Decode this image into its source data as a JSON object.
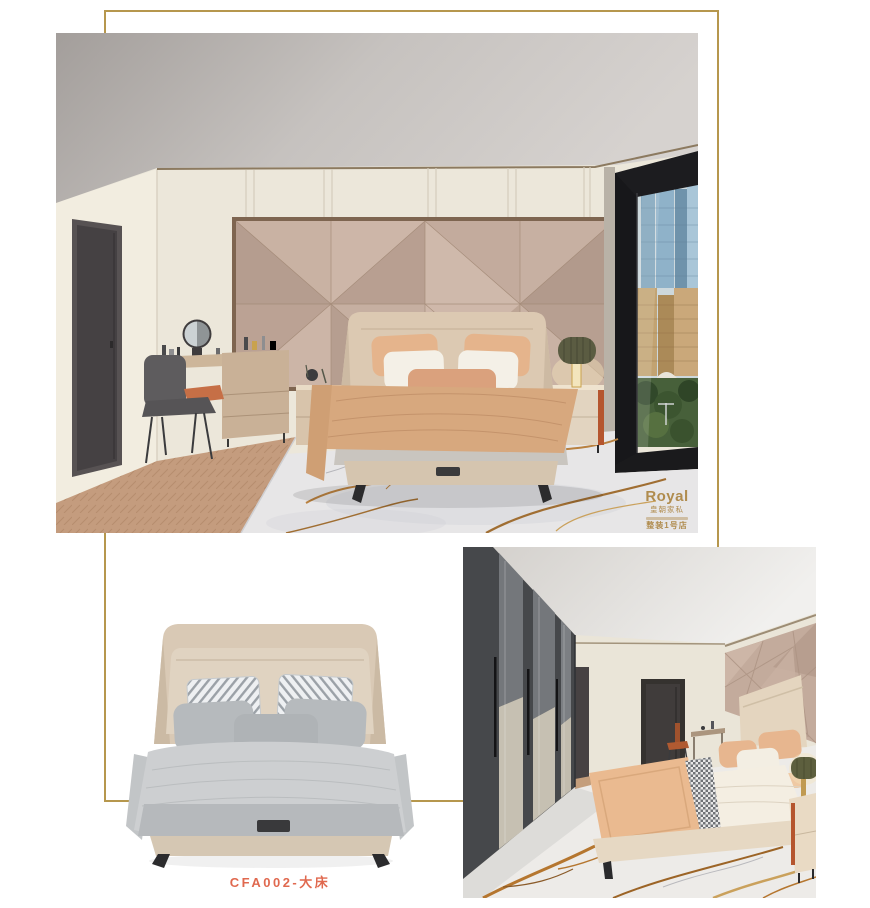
{
  "page": {
    "background": "#ffffff"
  },
  "frame": {
    "color": "#b6974d"
  },
  "product": {
    "label": "CFA002-大床",
    "label_color": "#e0694f"
  },
  "watermark": {
    "brand": "Royal",
    "brand_cn": "皇朝家私",
    "store": "整装1号店",
    "color": "#b08c4e"
  },
  "photos": {
    "hero": {
      "alt": "Bedroom render: beige upholstered bed, taupe geometric headboard wall, vanity with round mirror, marble rug, floor-to-ceiling window with city view"
    },
    "product": {
      "alt": "Product cutout: beige wing-headboard double bed with gray bedding and striped pillows on white background"
    },
    "secondary": {
      "alt": "Bedroom render: dark mirrored wardrobe corridor, beige bed with peach blanket, gold-veined marble floor"
    }
  },
  "palette": {
    "frame_gold": "#b6974d",
    "label_orange": "#e0694f",
    "watermark_gold": "#b08c4e",
    "wall_cream": "#ece7da",
    "panel_taupe": "#c0a99b",
    "wardrobe_charcoal": "#46484b",
    "marble_vein": "#b5762f",
    "bed_beige": "#d9c9b5",
    "bedding_gray": "#cdcfd1",
    "blanket_peach": "#d7a87e"
  }
}
